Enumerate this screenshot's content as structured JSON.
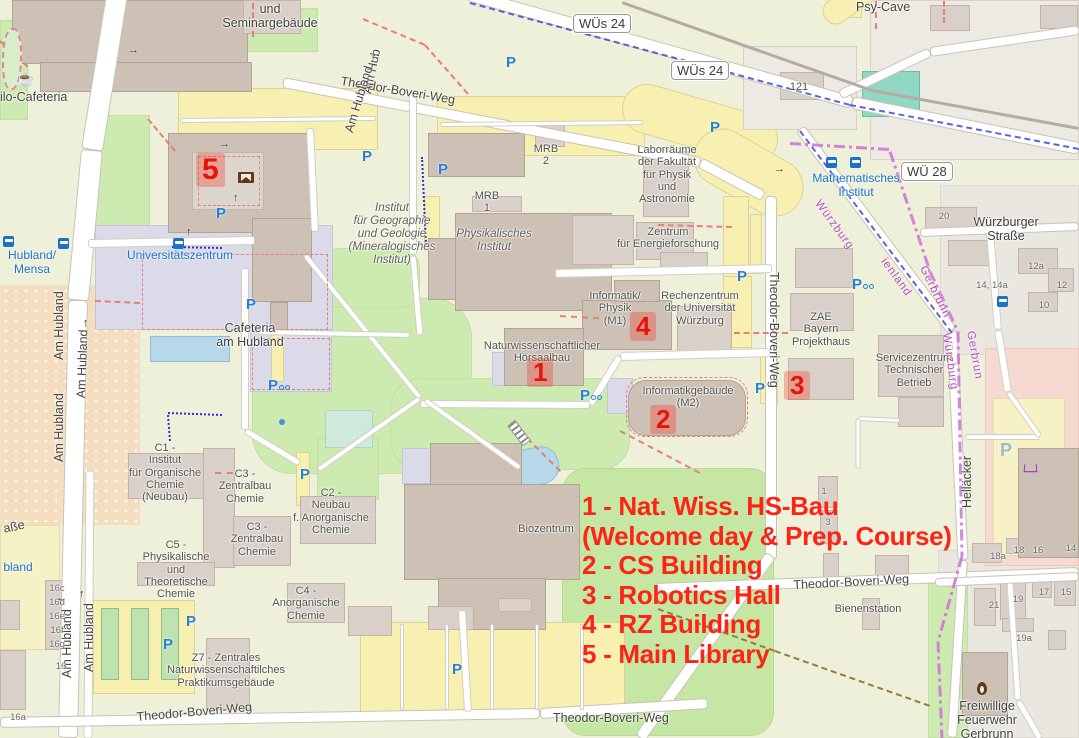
{
  "legend": {
    "color": "#fb2416",
    "lines": [
      "1 - Nat. Wiss. HS-Bau",
      "(Welcome day & Prep. Course)",
      "2 - CS Building",
      "3 - Robotics Hall",
      "4 - RZ Building",
      "5 - Main Library"
    ]
  },
  "markers": [
    {
      "n": "1",
      "x": 527,
      "y": 358,
      "big": false
    },
    {
      "n": "2",
      "x": 650,
      "y": 405,
      "big": false
    },
    {
      "n": "3",
      "x": 784,
      "y": 371,
      "big": false
    },
    {
      "n": "4",
      "x": 630,
      "y": 312,
      "big": false
    },
    {
      "n": "5",
      "x": 196,
      "y": 153,
      "big": true
    }
  ],
  "route_badges": [
    {
      "t": "WÜs 24",
      "x": 573,
      "y": 14
    },
    {
      "t": "WÜs 24",
      "x": 671,
      "y": 61
    },
    {
      "t": "WÜ 28",
      "x": 901,
      "y": 162
    }
  ],
  "streets": [
    {
      "t": "Theodor-Boveri-Weg",
      "x": 342,
      "y": 74,
      "r": 9.5,
      "ctr": false
    },
    {
      "t": "Theodor-Boveri-Weg",
      "x": 781,
      "y": 272,
      "r": 90,
      "ctr": false
    },
    {
      "t": "Theodor-Boveri-Weg",
      "x": 793,
      "y": 578,
      "r": -3,
      "ctr": false
    },
    {
      "t": "Theodor-Boveri-Weg",
      "x": 553,
      "y": 711,
      "r": 0,
      "ctr": false
    },
    {
      "t": "Theodor-Boveri-Weg",
      "x": 136,
      "y": 710,
      "r": -5,
      "ctr": false
    },
    {
      "t": "Am Hub",
      "x": 360,
      "y": 92,
      "r": -78,
      "ctr": false
    },
    {
      "t": "Am Hubland →",
      "x": 342,
      "y": 130,
      "r": -73,
      "ctr": false
    },
    {
      "t": "Am Hubland",
      "x": 52,
      "y": 360,
      "r": -90,
      "ctr": false
    },
    {
      "t": "Am Hubland→",
      "x": 74,
      "y": 398,
      "r": -88,
      "ctr": false
    },
    {
      "t": "Am Hubland",
      "x": 52,
      "y": 462,
      "r": -90,
      "ctr": false
    },
    {
      "t": "Am Hubland",
      "x": 60,
      "y": 678,
      "r": -90,
      "ctr": false
    },
    {
      "t": "Am Hubland",
      "x": 82,
      "y": 672,
      "r": -90,
      "ctr": false
    },
    {
      "t": "Helläcker",
      "x": 960,
      "y": 508,
      "r": -90,
      "ctr": false
    },
    {
      "t": "aße",
      "x": 2,
      "y": 522,
      "r": -12,
      "ctr": false
    },
    {
      "t": "Psy-Cave",
      "x": 856,
      "y": 0,
      "r": 0,
      "ctr": false
    }
  ],
  "places": [
    {
      "t": "und\nSeminargebäude",
      "cx": 270,
      "y": 2,
      "it": false,
      "med": true
    },
    {
      "t": "Philo-Cafeteria",
      "cx": 26,
      "y": 90,
      "it": false,
      "med": true
    },
    {
      "t": "Cafeteria\nam Hubland",
      "cx": 250,
      "y": 321,
      "it": false,
      "med": true
    },
    {
      "t": "MRB\n2",
      "cx": 546,
      "y": 143,
      "it": false,
      "med": false
    },
    {
      "t": "MRB\n1",
      "cx": 487,
      "y": 190,
      "it": false,
      "med": false
    },
    {
      "t": "Laborräume\nder Fakultät\nfür Physik\nund\nAstronomie",
      "cx": 667,
      "y": 144,
      "it": false,
      "med": false
    },
    {
      "t": "Zentrum\nfür Energieforschung",
      "cx": 668,
      "y": 226,
      "it": false,
      "med": false
    },
    {
      "t": "Informatik/\nPhysik\n(M1)",
      "cx": 615,
      "y": 290,
      "it": false,
      "med": false
    },
    {
      "t": "Rechenzentrum\nder Universität\nWürzburg",
      "cx": 700,
      "y": 290,
      "it": false,
      "med": false
    },
    {
      "t": "ZAE\nBayern\nProjekthaus",
      "cx": 821,
      "y": 311,
      "it": false,
      "med": false
    },
    {
      "t": "Servicezentrum\nTechnischer\nBetrieb",
      "cx": 914,
      "y": 352,
      "it": false,
      "med": false
    },
    {
      "t": "Naturwissenschaftlicher\nHörsaalbau",
      "cx": 542,
      "y": 340,
      "it": false,
      "med": false
    },
    {
      "t": "Informatikgebäude\n(M2)",
      "cx": 688,
      "y": 385,
      "it": false,
      "med": false
    },
    {
      "t": "Biozentrum",
      "cx": 546,
      "y": 523,
      "it": false,
      "med": false
    },
    {
      "t": "C1 -\nInstitut\nfür Organische\nChemie\n(Neubau)",
      "cx": 165,
      "y": 442,
      "it": false,
      "med": false
    },
    {
      "t": "C3 -\nZentralbau\nChemie",
      "cx": 245,
      "y": 468,
      "it": false,
      "med": false
    },
    {
      "t": "C3 -\nZentralbau\nChemie",
      "cx": 257,
      "y": 521,
      "it": false,
      "med": false
    },
    {
      "t": "C2 -\nNeubau\nf. Anorganische\nChemie",
      "cx": 331,
      "y": 487,
      "it": false,
      "med": false
    },
    {
      "t": "C5 -\nPhysikalische\nund\nTheoretische\nChemie",
      "cx": 176,
      "y": 539,
      "it": false,
      "med": false
    },
    {
      "t": "C4 -\nAnorganische\nChemie",
      "cx": 306,
      "y": 585,
      "it": false,
      "med": false
    },
    {
      "t": "Z7 - Zentrales\nNaturwissenschaftilches\nPraktikumsgebäude",
      "cx": 226,
      "y": 652,
      "it": false,
      "med": false
    },
    {
      "t": "Bienenstation",
      "cx": 868,
      "y": 603,
      "it": false,
      "med": false
    },
    {
      "t": "Freiwillige\nFeuerwehr\nGerbrunn",
      "cx": 987,
      "y": 699,
      "it": false,
      "med": true
    },
    {
      "t": "Würzburger\nStraße",
      "cx": 1006,
      "y": 215,
      "it": false,
      "med": true
    },
    {
      "t": "121",
      "cx": 799,
      "y": 81,
      "it": false,
      "med": false
    },
    {
      "t": "Institut\nfür Geographie\nund Geologie\n(Mineralogisches\nInstitut)",
      "cx": 392,
      "y": 202,
      "it": true,
      "med": false
    },
    {
      "t": "Physikalisches\nInstitut",
      "cx": 494,
      "y": 228,
      "it": true,
      "med": false
    }
  ],
  "transit_labels": [
    {
      "t": "Hubland/\nMensa",
      "cx": 32,
      "y": 249
    },
    {
      "t": "Universitätszentrum",
      "cx": 180,
      "y": 249
    },
    {
      "t": "Mathematisches\nInstitut",
      "cx": 856,
      "y": 172
    },
    {
      "t": "bland",
      "cx": 18,
      "y": 561
    }
  ],
  "boundary_labels": [
    {
      "t": "Würzburg",
      "x": 822,
      "y": 198,
      "r": 54
    },
    {
      "t": "ienland",
      "x": 888,
      "y": 256,
      "r": 54
    },
    {
      "t": "Gerbrunn",
      "x": 928,
      "y": 264,
      "r": 64
    },
    {
      "t": "Würzburg",
      "x": 952,
      "y": 332,
      "r": 82
    },
    {
      "t": "Gerbrun",
      "x": 976,
      "y": 330,
      "r": 80
    }
  ],
  "house_numbers": [
    {
      "t": "20",
      "x": 944,
      "y": 211
    },
    {
      "t": "12a",
      "x": 1036,
      "y": 261
    },
    {
      "t": "12",
      "x": 1062,
      "y": 280
    },
    {
      "t": "10",
      "x": 1044,
      "y": 300
    },
    {
      "t": "14, 14a",
      "x": 992,
      "y": 280
    },
    {
      "t": "18a",
      "x": 998,
      "y": 551
    },
    {
      "t": "18",
      "x": 1019,
      "y": 545
    },
    {
      "t": "16",
      "x": 1038,
      "y": 545
    },
    {
      "t": "14",
      "x": 1071,
      "y": 543
    },
    {
      "t": "21",
      "x": 994,
      "y": 600
    },
    {
      "t": "19",
      "x": 1018,
      "y": 594
    },
    {
      "t": "17",
      "x": 1044,
      "y": 587
    },
    {
      "t": "15",
      "x": 1066,
      "y": 587
    },
    {
      "t": "19a",
      "x": 1024,
      "y": 633
    },
    {
      "t": "16c",
      "x": 57,
      "y": 583
    },
    {
      "t": "16d",
      "x": 57,
      "y": 597
    },
    {
      "t": "16e",
      "x": 57,
      "y": 611
    },
    {
      "t": "16f",
      "x": 57,
      "y": 625
    },
    {
      "t": "16g",
      "x": 57,
      "y": 639
    },
    {
      "t": "16",
      "x": 61,
      "y": 661
    },
    {
      "t": "16a",
      "x": 18,
      "y": 712
    },
    {
      "t": "1",
      "x": 824,
      "y": 486
    },
    {
      "t": "3",
      "x": 828,
      "y": 517
    }
  ],
  "pois": [
    {
      "k": "parking",
      "x": 362,
      "y": 148
    },
    {
      "k": "parking",
      "x": 438,
      "y": 161
    },
    {
      "k": "parking",
      "x": 506,
      "y": 54
    },
    {
      "k": "parking",
      "x": 710,
      "y": 119
    },
    {
      "k": "parking",
      "x": 737,
      "y": 268
    },
    {
      "k": "parking",
      "x": 755,
      "y": 380
    },
    {
      "k": "parking",
      "x": 246,
      "y": 296
    },
    {
      "k": "parking",
      "x": 216,
      "y": 205
    },
    {
      "k": "parking",
      "x": 300,
      "y": 466
    },
    {
      "k": "parking",
      "x": 186,
      "y": 613
    },
    {
      "k": "parking",
      "x": 163,
      "y": 636
    },
    {
      "k": "parking",
      "x": 452,
      "y": 661
    },
    {
      "k": "parking-pale",
      "x": 1000,
      "y": 440
    },
    {
      "k": "parking-bike",
      "x": 580,
      "y": 387
    },
    {
      "k": "parking-bike",
      "x": 268,
      "y": 377
    },
    {
      "k": "parking-bike",
      "x": 852,
      "y": 276
    },
    {
      "k": "bus",
      "x": 3,
      "y": 236
    },
    {
      "k": "bus",
      "x": 58,
      "y": 238
    },
    {
      "k": "bus",
      "x": 173,
      "y": 238
    },
    {
      "k": "bus",
      "x": 826,
      "y": 157
    },
    {
      "k": "bus",
      "x": 850,
      "y": 157
    },
    {
      "k": "bus",
      "x": 997,
      "y": 296
    },
    {
      "k": "cafe",
      "x": 16,
      "y": 70
    },
    {
      "k": "book",
      "x": 238,
      "y": 172
    },
    {
      "k": "flame",
      "x": 977,
      "y": 682
    },
    {
      "k": "cart",
      "x": 1024,
      "y": 463
    },
    {
      "k": "monument",
      "x": 440,
      "y": 460
    },
    {
      "k": "dot",
      "x": 279,
      "y": 419
    },
    {
      "k": "arrow",
      "g": "→",
      "x": 219,
      "y": 138
    },
    {
      "k": "arrow",
      "g": "↑",
      "x": 233,
      "y": 192
    },
    {
      "k": "arrow",
      "g": "↑",
      "x": 186,
      "y": 226
    },
    {
      "k": "arrow",
      "g": "→",
      "x": 774,
      "y": 163
    },
    {
      "k": "arrow",
      "g": "←",
      "x": 56,
      "y": 592
    },
    {
      "k": "arrow",
      "g": "↑",
      "x": 79,
      "y": 588
    },
    {
      "k": "arrow",
      "g": "→",
      "x": 128,
      "y": 44
    }
  ],
  "poi_icon_map": {
    "parking": "parking-icon",
    "parking-pale": "parking-icon",
    "parking-bike": "park-and-bike-icon",
    "bus": "bus-stop-icon",
    "cafe": "cafe-icon",
    "book": "library-icon",
    "flame": "fire-station-icon",
    "cart": "supermarket-icon",
    "monument": "monument-icon",
    "dot": "poi-dot-icon",
    "arrow": "oneway-arrow-icon"
  },
  "colors": {
    "legend_red": "#fb2416",
    "marker_red": "#e6140a",
    "transit_blue": "#1a72c8",
    "boundary_purple": "#b44fc4",
    "park_green": "#cdebb0",
    "building": "#d9d0c9"
  }
}
